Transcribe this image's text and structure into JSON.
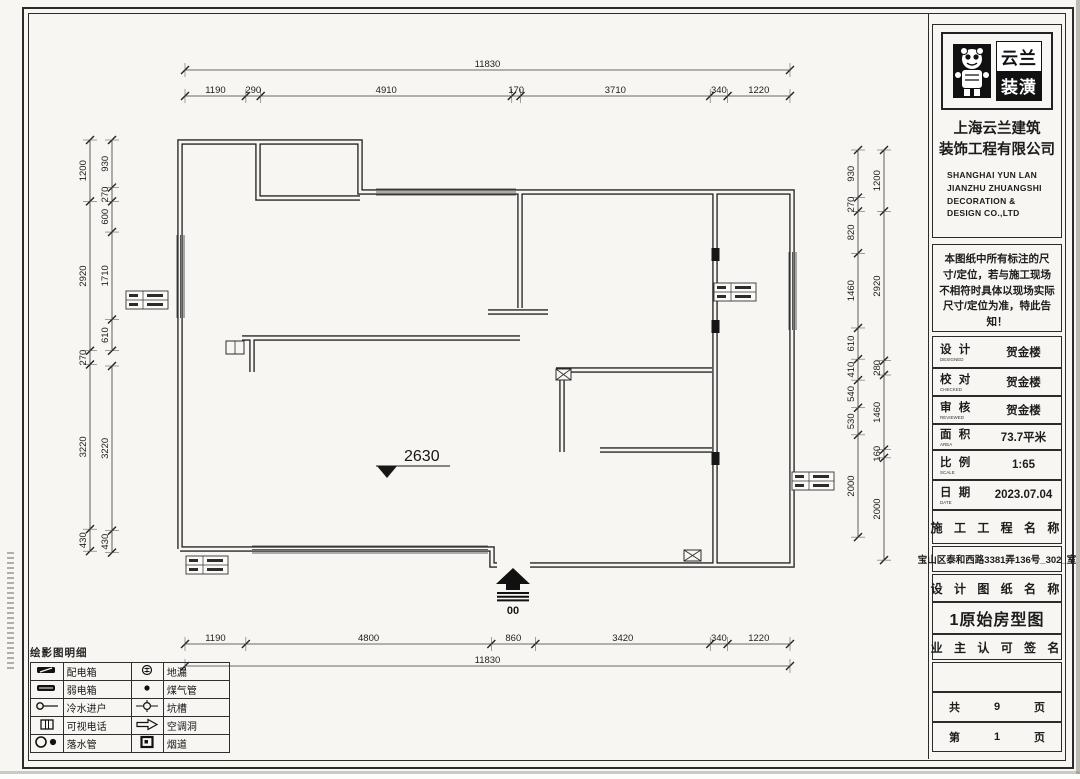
{
  "title_block": {
    "brand_top": "云兰",
    "brand_bottom": "装潢",
    "company_cn": [
      "上海云兰建筑",
      "装饰工程有限公司"
    ],
    "company_en": [
      "SHANGHAI YUN LAN",
      "JIANZHU ZHUANGSHI",
      "DECORATION &",
      "DESIGN CO.,LTD"
    ],
    "notice": "本图纸中所有标注的尺寸/定位，若与施工现场不相符时具体以现场实际尺寸/定位为准，特此告知！",
    "info_rows": [
      {
        "label": "设 计",
        "sub": "DESIGNED",
        "value": "贺金楼"
      },
      {
        "label": "校 对",
        "sub": "CHECKED",
        "value": "贺金楼"
      },
      {
        "label": "审 核",
        "sub": "REVIEWED",
        "value": "贺金楼"
      },
      {
        "label": "面 积",
        "sub": "AREA",
        "value": "73.7平米"
      },
      {
        "label": "比 例",
        "sub": "SCALE",
        "value": "1:65"
      },
      {
        "label": "日 期",
        "sub": "DATE",
        "value": "2023.07.04"
      }
    ],
    "project_header": "施 工 工 程 名 称",
    "project_address": "宝山区泰和西路3381弄136号_302_室",
    "drawing_header": "设 计 图 纸 名 称",
    "drawing_title": "1原始房型图",
    "owner_header": "业 主 认 可 签 名",
    "pages_total": {
      "pre": "共",
      "num": "9",
      "suf": "页"
    },
    "page_current": {
      "pre": "第",
      "num": "1",
      "suf": "页"
    }
  },
  "legend": {
    "title": "绘影图明细",
    "rows": [
      {
        "icon1": "distribution-box",
        "label1": "配电箱",
        "icon2": "floor-drain",
        "label2": "地漏"
      },
      {
        "icon1": "weak-current-box",
        "label1": "弱电箱",
        "icon2": "gas-pipe",
        "label2": "煤气管"
      },
      {
        "icon1": "cold-water-inlet",
        "label1": "冷水进户",
        "icon2": "pit-slot",
        "label2": "坑槽"
      },
      {
        "icon1": "video-phone",
        "label1": "可视电话",
        "icon2": "ac-hole",
        "label2": "空调洞"
      },
      {
        "icon1": "down-pipe",
        "label1": "落水管",
        "icon2": "flue",
        "label2": "烟道"
      }
    ]
  },
  "plan": {
    "ceiling_height": "2630",
    "entrance_label": "00",
    "scale_px_per_mm": 0.05114,
    "dim_chains": [
      {
        "name": "top-overall",
        "dir": "h",
        "x": 185,
        "y": 70,
        "segments": [
          "11830"
        ]
      },
      {
        "name": "top-segments",
        "dir": "h",
        "x": 185,
        "y": 96,
        "segments": [
          "1190",
          "290",
          "4910",
          "170",
          "3710",
          "340",
          "1220"
        ]
      },
      {
        "name": "bottom-segments",
        "dir": "h",
        "x": 185,
        "y": 644,
        "segments": [
          "1190",
          "4800",
          "860",
          "3420",
          "340",
          "1220"
        ]
      },
      {
        "name": "bottom-overall",
        "dir": "h",
        "x": 185,
        "y": 666,
        "segments": [
          "11830"
        ]
      },
      {
        "name": "left-outer",
        "dir": "v",
        "x": 90,
        "y": 140,
        "segments": [
          "1200",
          "2920",
          "270",
          "3220",
          "430"
        ]
      },
      {
        "name": "left-inner-upper",
        "dir": "v",
        "x": 112,
        "y": 140,
        "segments": [
          "930",
          "270",
          "600",
          "1710",
          "610"
        ]
      },
      {
        "name": "left-inner-lower",
        "dir": "v",
        "x": 112,
        "y": 366,
        "segments": [
          "3220",
          "430"
        ]
      },
      {
        "name": "right-inner",
        "dir": "v",
        "x": 858,
        "y": 150,
        "segments": [
          "930",
          "270",
          "820",
          "1460",
          "610",
          "410",
          "540",
          "530",
          "2000"
        ]
      },
      {
        "name": "right-outer",
        "dir": "v",
        "x": 884,
        "y": 150,
        "segments": [
          "1200",
          "2920",
          "280",
          "1460",
          "160",
          "2000"
        ]
      }
    ]
  }
}
